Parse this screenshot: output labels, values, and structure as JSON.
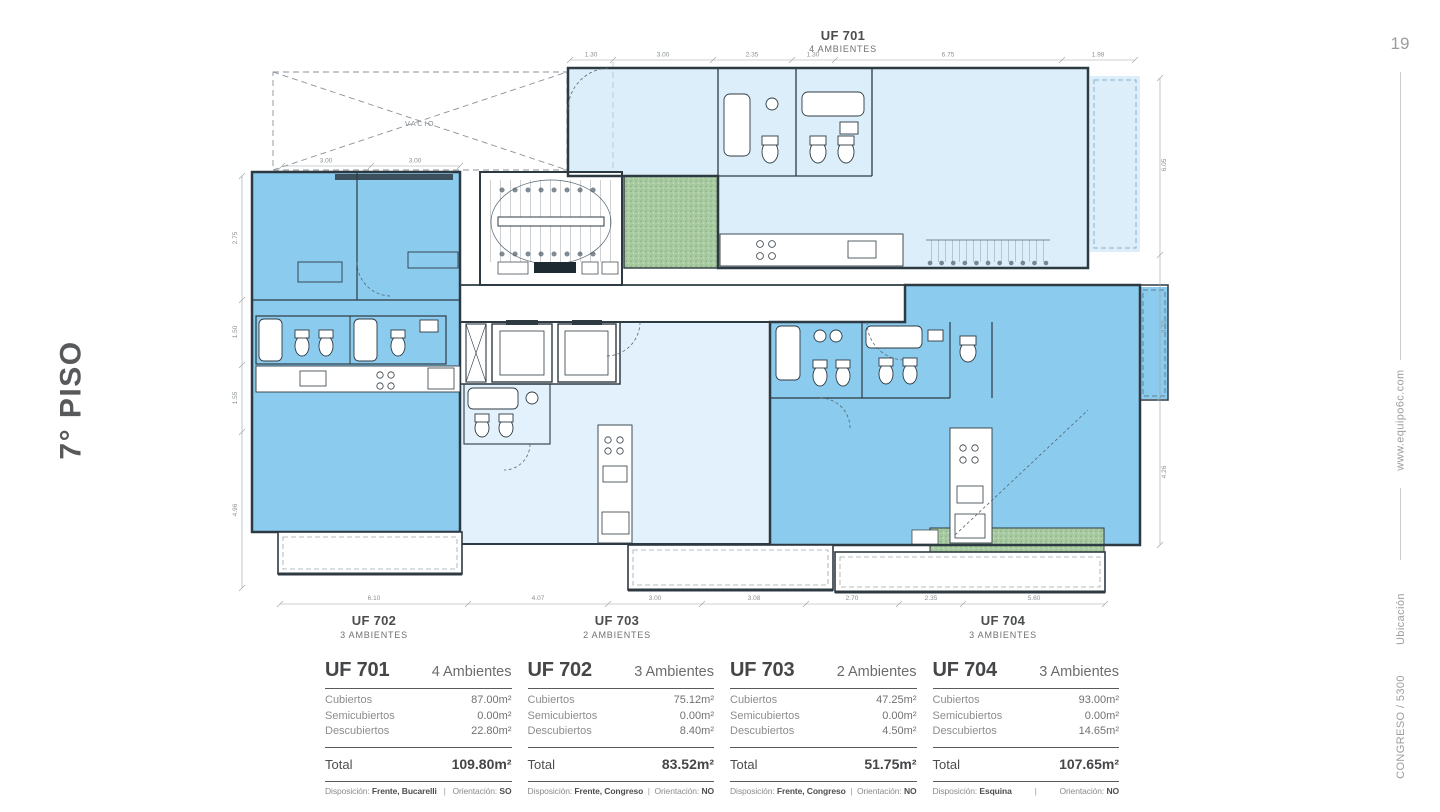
{
  "page": {
    "number": "19",
    "floor_title": "7° PISO",
    "website": "www.equipo6c.com",
    "project": "CONGRESO / 5300",
    "section": "Ubicación"
  },
  "plan": {
    "void_label": "VACIO",
    "top_unit": {
      "name": "UF 701",
      "type": "4 AMBIENTES"
    },
    "bottom_units": [
      {
        "name": "UF 702",
        "type": "3 AMBIENTES"
      },
      {
        "name": "UF 703",
        "type": "2 AMBIENTES"
      },
      {
        "name": "UF 704",
        "type": "3 AMBIENTES"
      }
    ],
    "dims_top": [
      "1.30",
      "3.00",
      "2.35",
      "1.30",
      "6.75",
      "1.98"
    ],
    "dims_top_left": [
      "3.00",
      "3.00"
    ],
    "dims_left": [
      "2.75",
      "1.50",
      "1.55",
      "4.96"
    ],
    "dims_right": [
      "6.05",
      "3.72",
      "4.26"
    ],
    "dims_bottom": [
      "6.10",
      "4.07",
      "3.00",
      "3.08",
      "2.70",
      "2.35",
      "5.60"
    ],
    "colors": {
      "unit_blue": "#8BCBEE",
      "unit_pale_blue": "#DBEEFA",
      "unit_pale_blue_2": "#E2F1FB",
      "terrace_green": "#A9CBA2",
      "wall_line": "#2E3A42"
    }
  },
  "units": [
    {
      "name": "UF 701",
      "ambientes": "4 Ambientes",
      "rows": [
        {
          "label": "Cubiertos",
          "value": "87.00m²"
        },
        {
          "label": "Semicubiertos",
          "value": "0.00m²"
        },
        {
          "label": "Descubiertos",
          "value": "22.80m²"
        }
      ],
      "total_label": "Total",
      "total": "109.80m²",
      "disposicion_label": "Disposición:",
      "disposicion": "Frente, Bucarelli",
      "orientacion_label": "Orientación:",
      "orientacion": "SO"
    },
    {
      "name": "UF 702",
      "ambientes": "3 Ambientes",
      "rows": [
        {
          "label": "Cubiertos",
          "value": "75.12m²"
        },
        {
          "label": "Semicubiertos",
          "value": "0.00m²"
        },
        {
          "label": "Descubiertos",
          "value": "8.40m²"
        }
      ],
      "total_label": "Total",
      "total": "83.52m²",
      "disposicion_label": "Disposición:",
      "disposicion": "Frente, Congreso",
      "orientacion_label": "Orientación:",
      "orientacion": "NO"
    },
    {
      "name": "UF 703",
      "ambientes": "2 Ambientes",
      "rows": [
        {
          "label": "Cubiertos",
          "value": "47.25m²"
        },
        {
          "label": "Semicubiertos",
          "value": "0.00m²"
        },
        {
          "label": "Descubiertos",
          "value": "4.50m²"
        }
      ],
      "total_label": "Total",
      "total": "51.75m²",
      "disposicion_label": "Disposición:",
      "disposicion": "Frente, Congreso",
      "orientacion_label": "Orientación:",
      "orientacion": "NO"
    },
    {
      "name": "UF 704",
      "ambientes": "3 Ambientes",
      "rows": [
        {
          "label": "Cubiertos",
          "value": "93.00m²"
        },
        {
          "label": "Semicubiertos",
          "value": "0.00m²"
        },
        {
          "label": "Descubiertos",
          "value": "14.65m²"
        }
      ],
      "total_label": "Total",
      "total": "107.65m²",
      "disposicion_label": "Disposición:",
      "disposicion": "Esquina",
      "orientacion_label": "Orientación:",
      "orientacion": "NO"
    }
  ]
}
